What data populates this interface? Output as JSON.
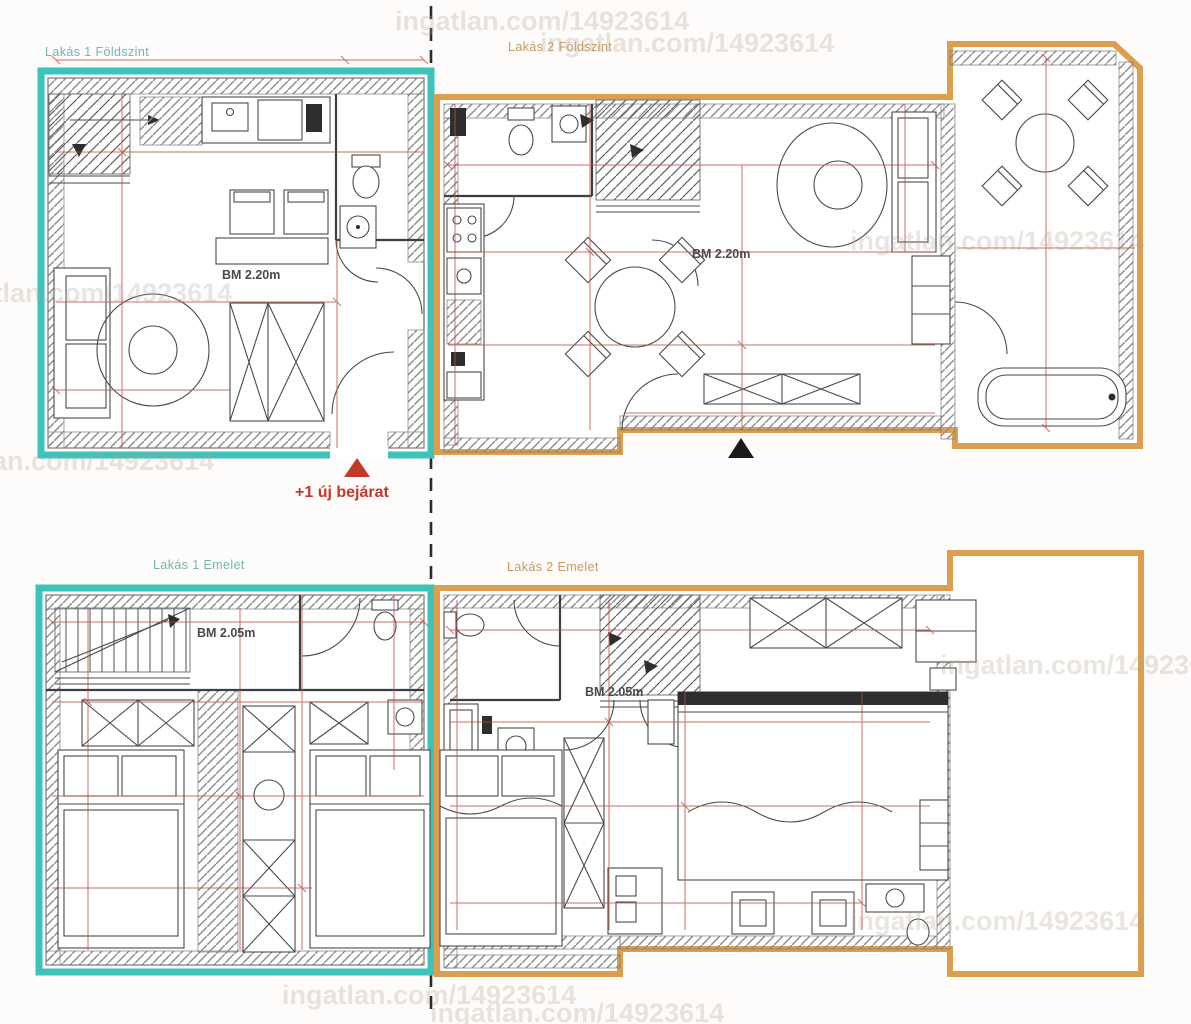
{
  "colors": {
    "unit1_outline": "#3cc4bb",
    "unit2_outline": "#dd9f4e",
    "dimension": "#c14b43",
    "wall_line": "#3f3f3f",
    "label_unit1": "#74b5b0",
    "label_unit2": "#c89a64",
    "bm_text": "#4a4a4a",
    "new_entrance": "#c0392b",
    "entrance_marker_dark": "#1a1a1a",
    "watermark": "#b5a38d"
  },
  "units": [
    {
      "id": "lakas-1-foldszint",
      "label": "Lakás 1 Földszint",
      "floor": "ground",
      "bm_label": "BM 2.20m"
    },
    {
      "id": "lakas-2-foldszint",
      "label": "Lakás 2 Földszint",
      "floor": "ground",
      "bm_label": "BM 2.20m"
    },
    {
      "id": "lakas-1-emelet",
      "label": "Lakás 1 Emelet",
      "floor": "upper",
      "bm_label": "BM 2.05m"
    },
    {
      "id": "lakas-2-emelet",
      "label": "Lakás 2 Emelet",
      "floor": "upper",
      "bm_label": "BM 2.05m"
    }
  ],
  "annotations": {
    "new_entrance_label": "+1 új bejárat"
  },
  "watermark": {
    "text": "ingatlan.com/14923614"
  }
}
